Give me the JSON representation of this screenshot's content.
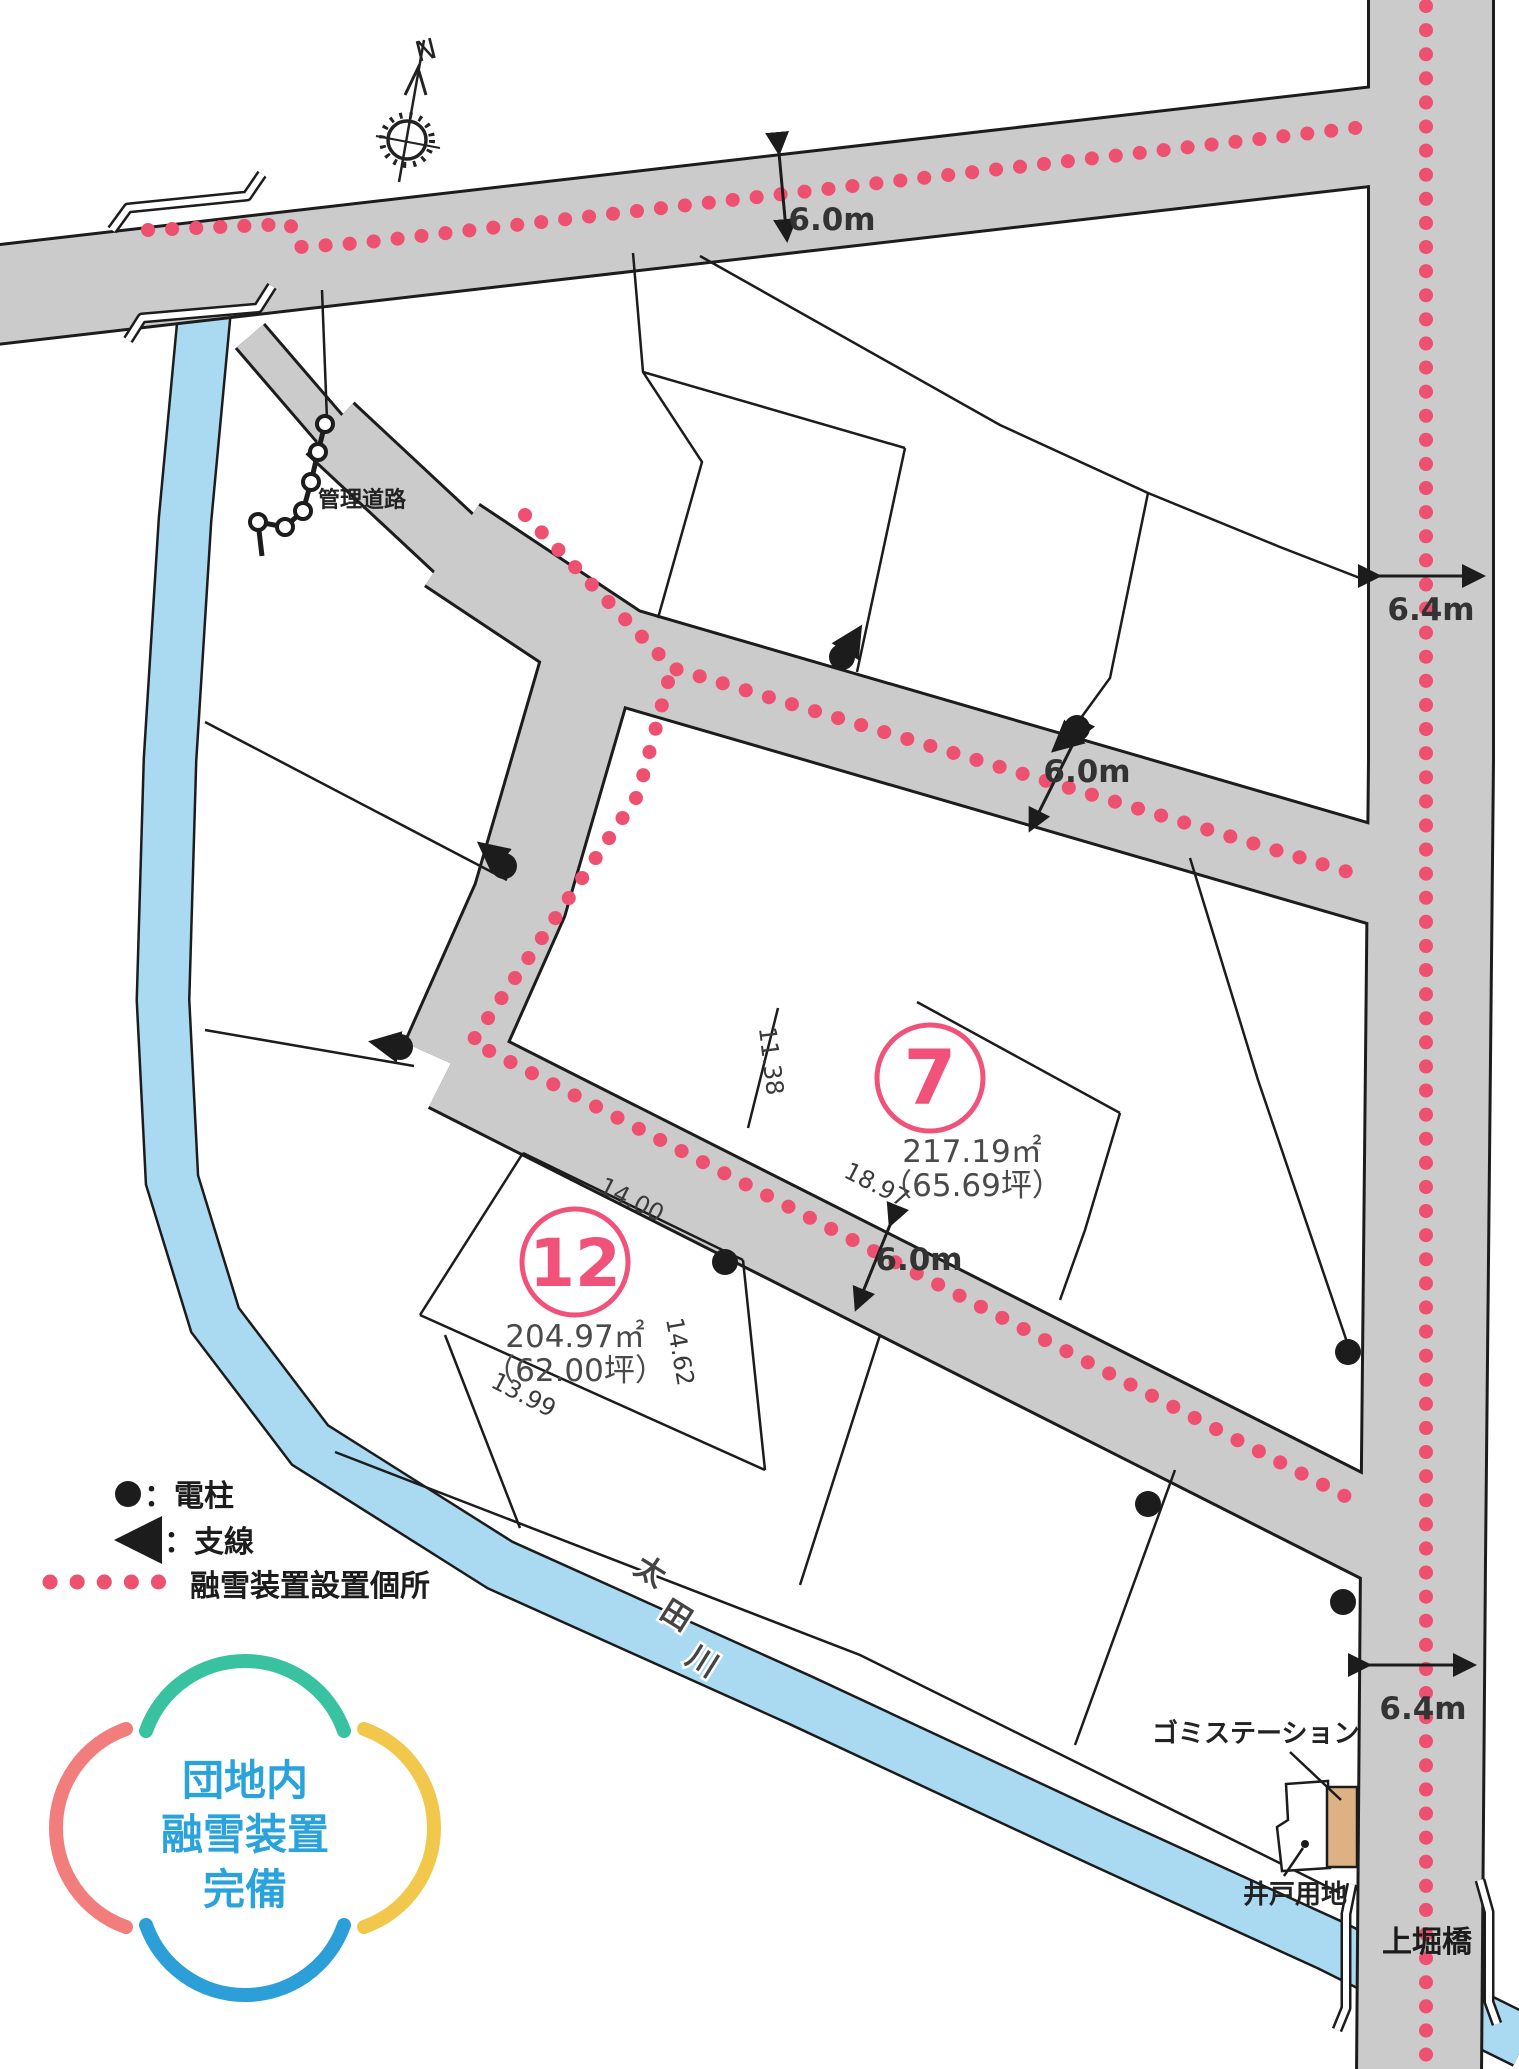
{
  "compass": {
    "north_label": "N"
  },
  "roads": {
    "management_road_label": "管理道路",
    "bridge_label": "上堀橋",
    "width_labels": [
      {
        "id": "top",
        "text": "6.0m"
      },
      {
        "id": "mid",
        "text": "6.0m"
      },
      {
        "id": "lower",
        "text": "6.0m"
      },
      {
        "id": "right_top",
        "text": "6.4m"
      },
      {
        "id": "right_bottom",
        "text": "6.4m"
      }
    ]
  },
  "river": {
    "name_chars": [
      "太",
      "田",
      "川"
    ]
  },
  "lots": [
    {
      "number": "7",
      "area_m2": "217.19㎡",
      "area_tsubo": "（65.69坪）"
    },
    {
      "number": "12",
      "area_m2": "204.97㎡",
      "area_tsubo": "（62.00坪）"
    }
  ],
  "edge_dimensions": [
    {
      "text": "14.00"
    },
    {
      "text": "14.62"
    },
    {
      "text": "13.99"
    },
    {
      "text": "18.97"
    },
    {
      "text": "11.38"
    }
  ],
  "facilities": {
    "garbage_station": "ゴミステーション",
    "well_site": "井戸用地"
  },
  "legend": {
    "pole_label": "：電柱",
    "guy_label": "：支線",
    "snowmelt_label": "融雪装置設置個所"
  },
  "badge": {
    "line1": "団地内",
    "line2": "融雪装置",
    "line3": "完備"
  },
  "colors": {
    "road": "#cbcbcb",
    "outline": "#1c1c1c",
    "river": "#aad9f2",
    "snowmelt_dots": "#ee5170",
    "lot_accent": "#f0527a",
    "badge_teal": "#38c2a0",
    "badge_salmon": "#f17d7d",
    "badge_yellow": "#f2c84c",
    "badge_blue": "#2d9fd8",
    "badge_text": "#2aa2dc",
    "garbage_box": "#dcb183"
  }
}
